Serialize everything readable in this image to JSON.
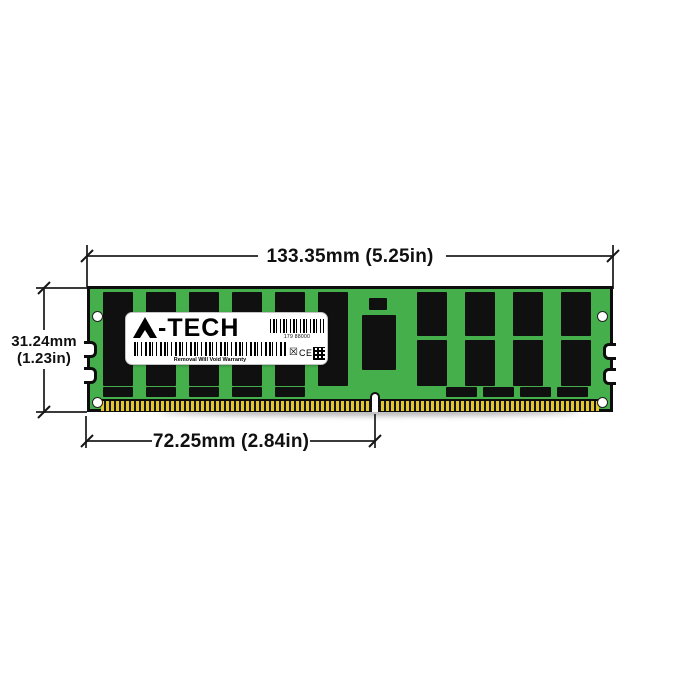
{
  "dimensions": {
    "width_label": "133.35mm (5.25in)",
    "height_label_mm": "31.24mm",
    "height_label_in": "(1.23in)",
    "contact_width_label": "72.25mm (2.84in)"
  },
  "label": {
    "brand": "A-TECH",
    "brand_suffix": "-TECH",
    "serial": "179 88000",
    "warranty": "Removal Will Void Warranty",
    "ce_mark": "CE"
  },
  "colors": {
    "pcb_green": "#44AF4B",
    "chip_black": "#101010",
    "pin_gold": "#E2C52F",
    "dimension_line": "#3A3A3A"
  },
  "module": {
    "chips": [
      {
        "x": 103,
        "y": 292,
        "w": 30,
        "h": 94
      },
      {
        "x": 146,
        "y": 292,
        "w": 30,
        "h": 94
      },
      {
        "x": 189,
        "y": 292,
        "w": 30,
        "h": 94
      },
      {
        "x": 232,
        "y": 292,
        "w": 30,
        "h": 94
      },
      {
        "x": 275,
        "y": 292,
        "w": 30,
        "h": 94
      },
      {
        "x": 318,
        "y": 292,
        "w": 30,
        "h": 94
      },
      {
        "x": 369,
        "y": 298,
        "w": 18,
        "h": 12
      },
      {
        "x": 362,
        "y": 315,
        "w": 34,
        "h": 55
      },
      {
        "x": 417,
        "y": 292,
        "w": 30,
        "h": 44
      },
      {
        "x": 465,
        "y": 292,
        "w": 30,
        "h": 44
      },
      {
        "x": 513,
        "y": 292,
        "w": 30,
        "h": 44
      },
      {
        "x": 561,
        "y": 292,
        "w": 30,
        "h": 44
      },
      {
        "x": 417,
        "y": 340,
        "w": 30,
        "h": 46
      },
      {
        "x": 465,
        "y": 340,
        "w": 30,
        "h": 46
      },
      {
        "x": 513,
        "y": 340,
        "w": 30,
        "h": 46
      },
      {
        "x": 561,
        "y": 340,
        "w": 30,
        "h": 46
      },
      {
        "x": 103,
        "y": 387,
        "w": 30,
        "h": 10
      },
      {
        "x": 146,
        "y": 387,
        "w": 30,
        "h": 10
      },
      {
        "x": 189,
        "y": 387,
        "w": 30,
        "h": 10
      },
      {
        "x": 232,
        "y": 387,
        "w": 30,
        "h": 10
      },
      {
        "x": 275,
        "y": 387,
        "w": 30,
        "h": 10
      },
      {
        "x": 446,
        "y": 387,
        "w": 31,
        "h": 10
      },
      {
        "x": 483,
        "y": 387,
        "w": 31,
        "h": 10
      },
      {
        "x": 520,
        "y": 387,
        "w": 31,
        "h": 10
      },
      {
        "x": 557,
        "y": 387,
        "w": 31,
        "h": 10
      }
    ]
  }
}
